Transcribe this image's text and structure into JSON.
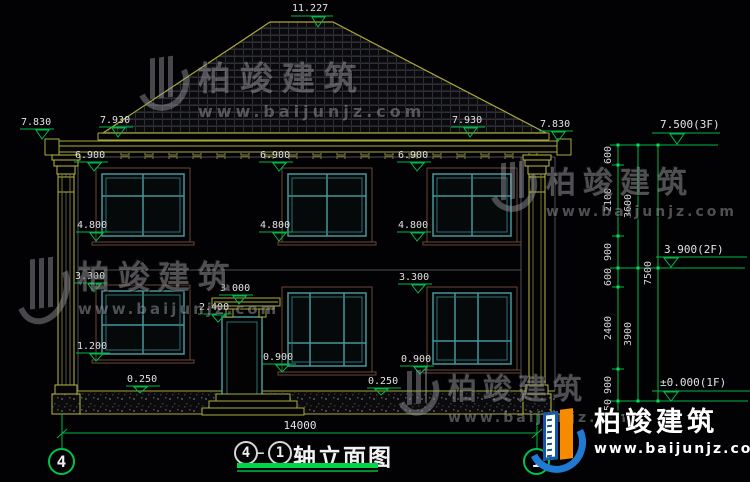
{
  "drawing": {
    "title": {
      "axis_left": "4",
      "separator": "—",
      "axis_right": "1",
      "name": "轴立面图"
    },
    "axis_bubbles": {
      "left": "4",
      "right": "1"
    },
    "levels": {
      "ridge": "11.227",
      "eave_outer": "7.830",
      "eave_inner": "7.930",
      "floor3": "7.500(3F)",
      "floor2": "3.900(2F)",
      "floor1": "±0.000(1F)",
      "win2_head": "6.900",
      "win2_sill": "4.800",
      "win1_head": "3.300",
      "win1_sill_left": "1.200",
      "porch_roof": "3.000",
      "door_head": "2.400",
      "win1_sill": "0.900",
      "plinth": "0.250"
    },
    "dims": {
      "total_width": "14000",
      "inner": [
        "600",
        "2100",
        "900",
        "600",
        "2400",
        "900",
        "450"
      ],
      "mid": [
        "3600",
        "3900"
      ],
      "outer": [
        "7500"
      ]
    }
  },
  "watermark": {
    "brand": "柏竣建筑",
    "url": "www.baijunjz.com"
  },
  "logo": {
    "brand": "柏竣建筑",
    "url": "www.baijunjz.com"
  }
}
